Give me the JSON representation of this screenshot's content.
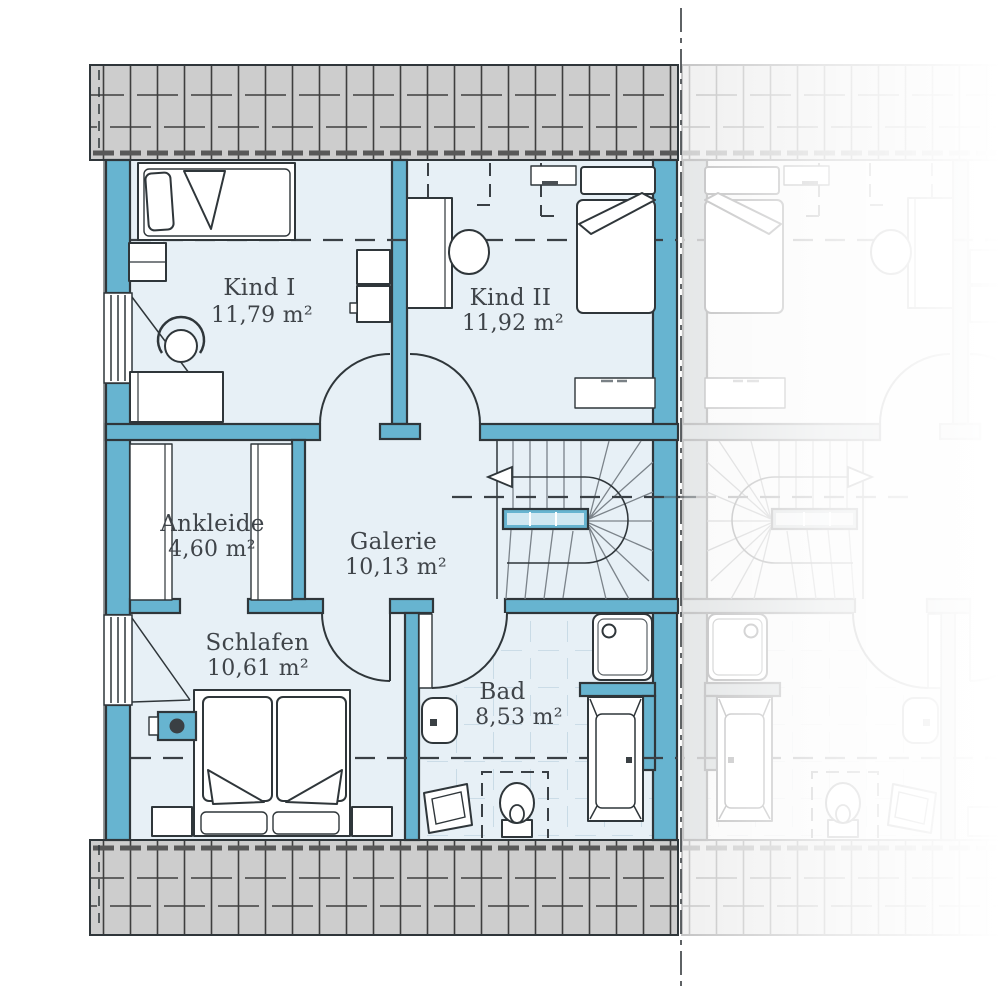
{
  "rooms": [
    {
      "id": "kind1",
      "name": "Kind I",
      "area": "11,79 m²"
    },
    {
      "id": "kind2",
      "name": "Kind II",
      "area": "11,92 m²"
    },
    {
      "id": "ankleide",
      "name": "Ankleide",
      "area": "4,60 m²"
    },
    {
      "id": "galerie",
      "name": "Galerie",
      "area": "10,13 m²"
    },
    {
      "id": "schlafen",
      "name": "Schlafen",
      "area": "10,61 m²"
    },
    {
      "id": "bad",
      "name": "Bad",
      "area": "8,53 m²"
    }
  ],
  "colors": {
    "wall": "#67b4d0",
    "floor": "#e7f0f6",
    "roof": "#cdcdcd",
    "line": "#2f363a",
    "text": "#3f4449",
    "tileline": "#c2d6e2",
    "stairline": "#7b838a"
  }
}
